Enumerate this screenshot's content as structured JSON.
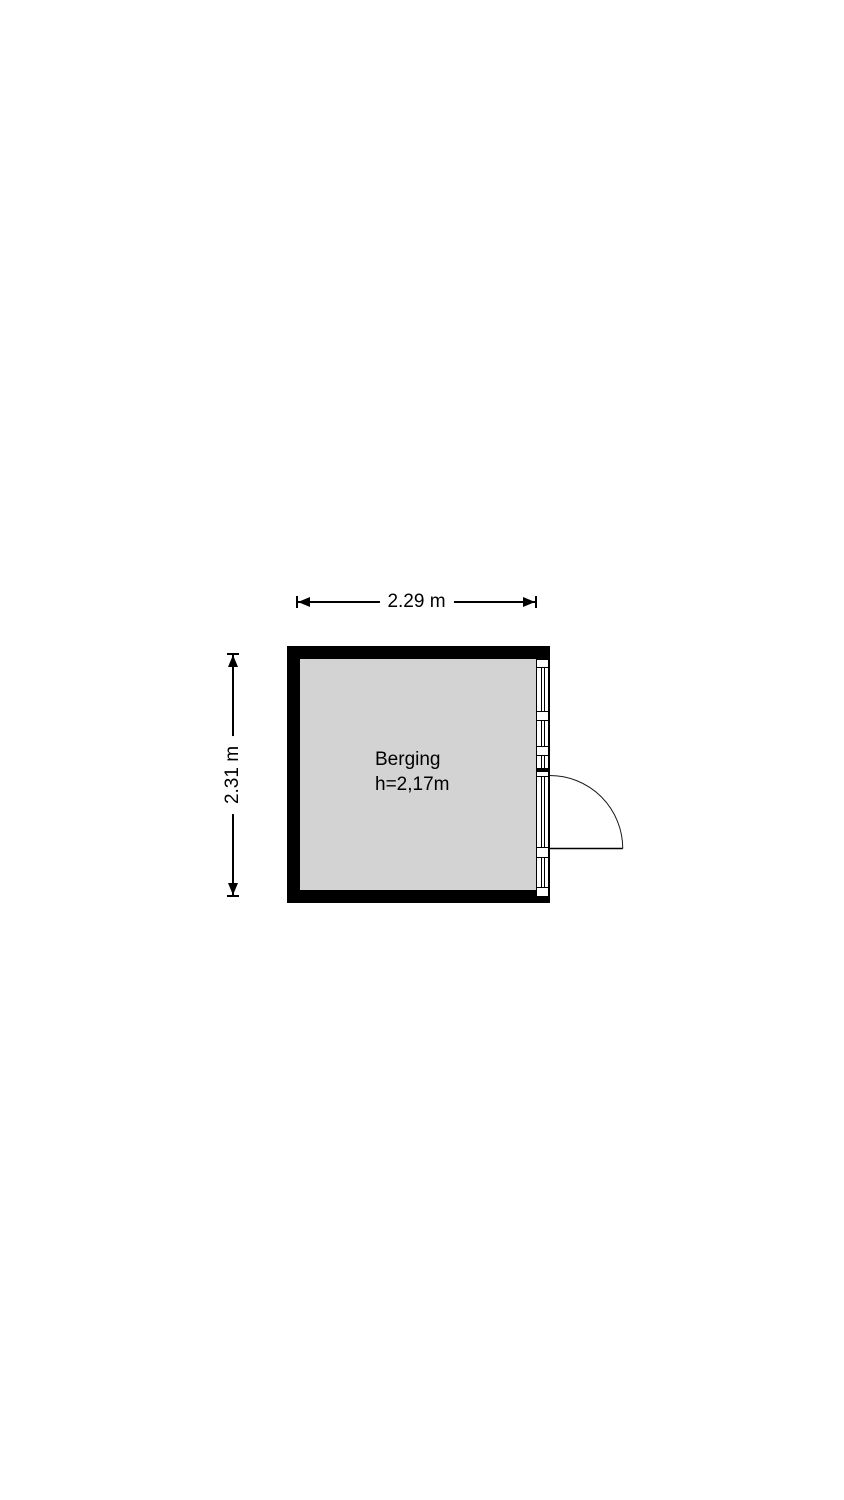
{
  "floorplan": {
    "room": {
      "name": "Berging",
      "ceiling_height": "h=2,17m"
    },
    "dimensions": {
      "width_label": "2.29 m",
      "height_label": "2.31 m"
    },
    "colors": {
      "wall": "#000000",
      "floor": "#d3d3d3",
      "line": "#000000",
      "background": "#ffffff"
    }
  }
}
